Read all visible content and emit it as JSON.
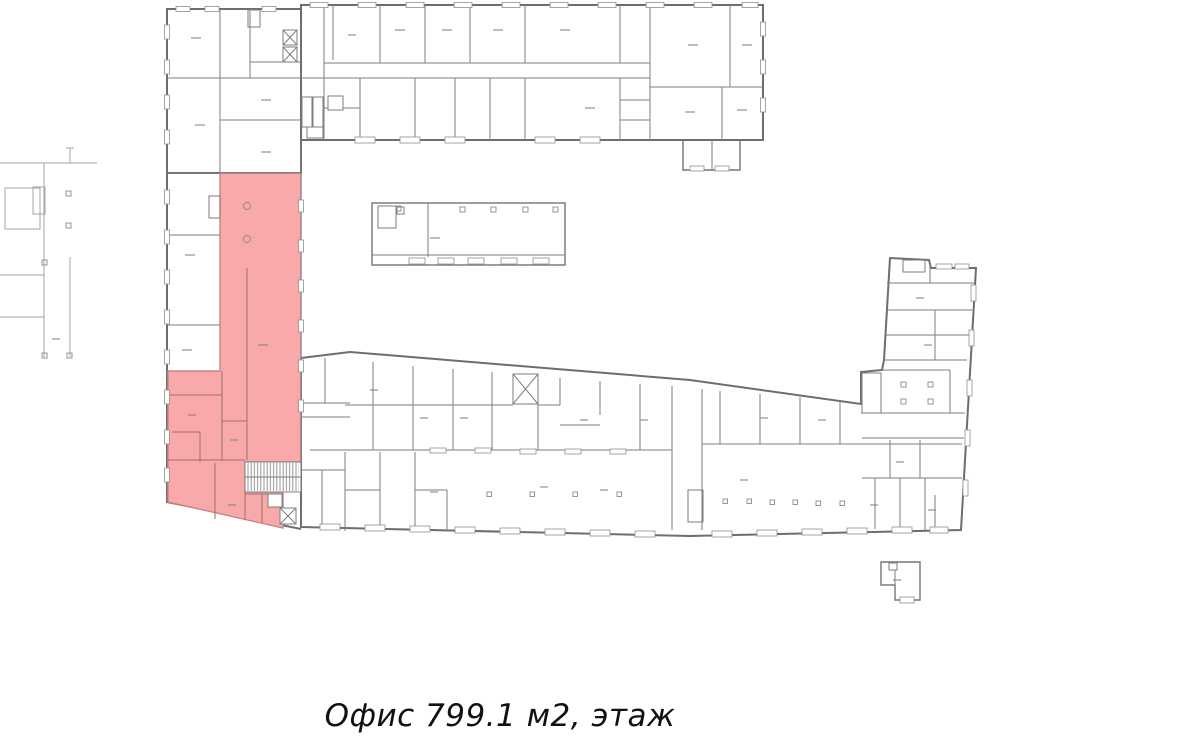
{
  "caption": {
    "label": "Офис 799.1 м2, этаж"
  },
  "plan": {
    "highlight_color": "#f9a9a9",
    "highlight_border_color": "#c98484",
    "wall_color": "#7e7e7e",
    "light_wall_color": "#a6a6a6",
    "background_color": "#ffffff",
    "symbols": {
      "staircase": "hatched-rect",
      "elevator": "crossed-box",
      "column": "small-square-marker",
      "window": "wall-gap-rect",
      "room_label": "short-dash"
    }
  }
}
